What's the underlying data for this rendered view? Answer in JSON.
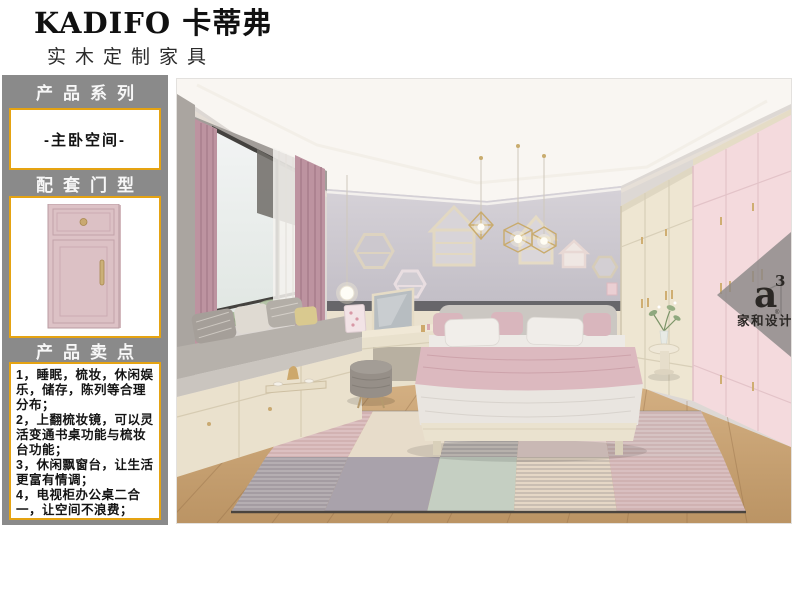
{
  "header": {
    "brand": "KADIFO 卡蒂弗",
    "tagline": "实木定制家具"
  },
  "sidebar": {
    "series_label": "产品系列",
    "series_value": "-主卧空间-",
    "door_type_label": "配套门型",
    "selling_points_label": "产品卖点",
    "selling_points": [
      "1，睡眠，梳妆，休闲娱乐，储存，陈列等合理分布；",
      "2，上翻梳妆镜，可以灵活变通书桌功能与梳妆台功能；",
      "3，休闲飘窗台，让生活更富有情调；",
      "4，电视柜办公桌二合一，让空间不浪费；"
    ]
  },
  "photo": {
    "watermark": {
      "logo": "a",
      "logo_sup": "3",
      "reg": "®",
      "brand": "家和设计"
    }
  },
  "colors": {
    "accent_gold": "#e5a312",
    "sidebar_grey": "#8a8a8a",
    "door_pink": "#ddc2c6",
    "wall_grey": "#c8c4ca",
    "wardrobe_cream": "#ece4d0",
    "wardrobe_pink": "#f4dadd",
    "curtain_mauve": "#bd93a0",
    "floor_wood": "#c7a276"
  }
}
